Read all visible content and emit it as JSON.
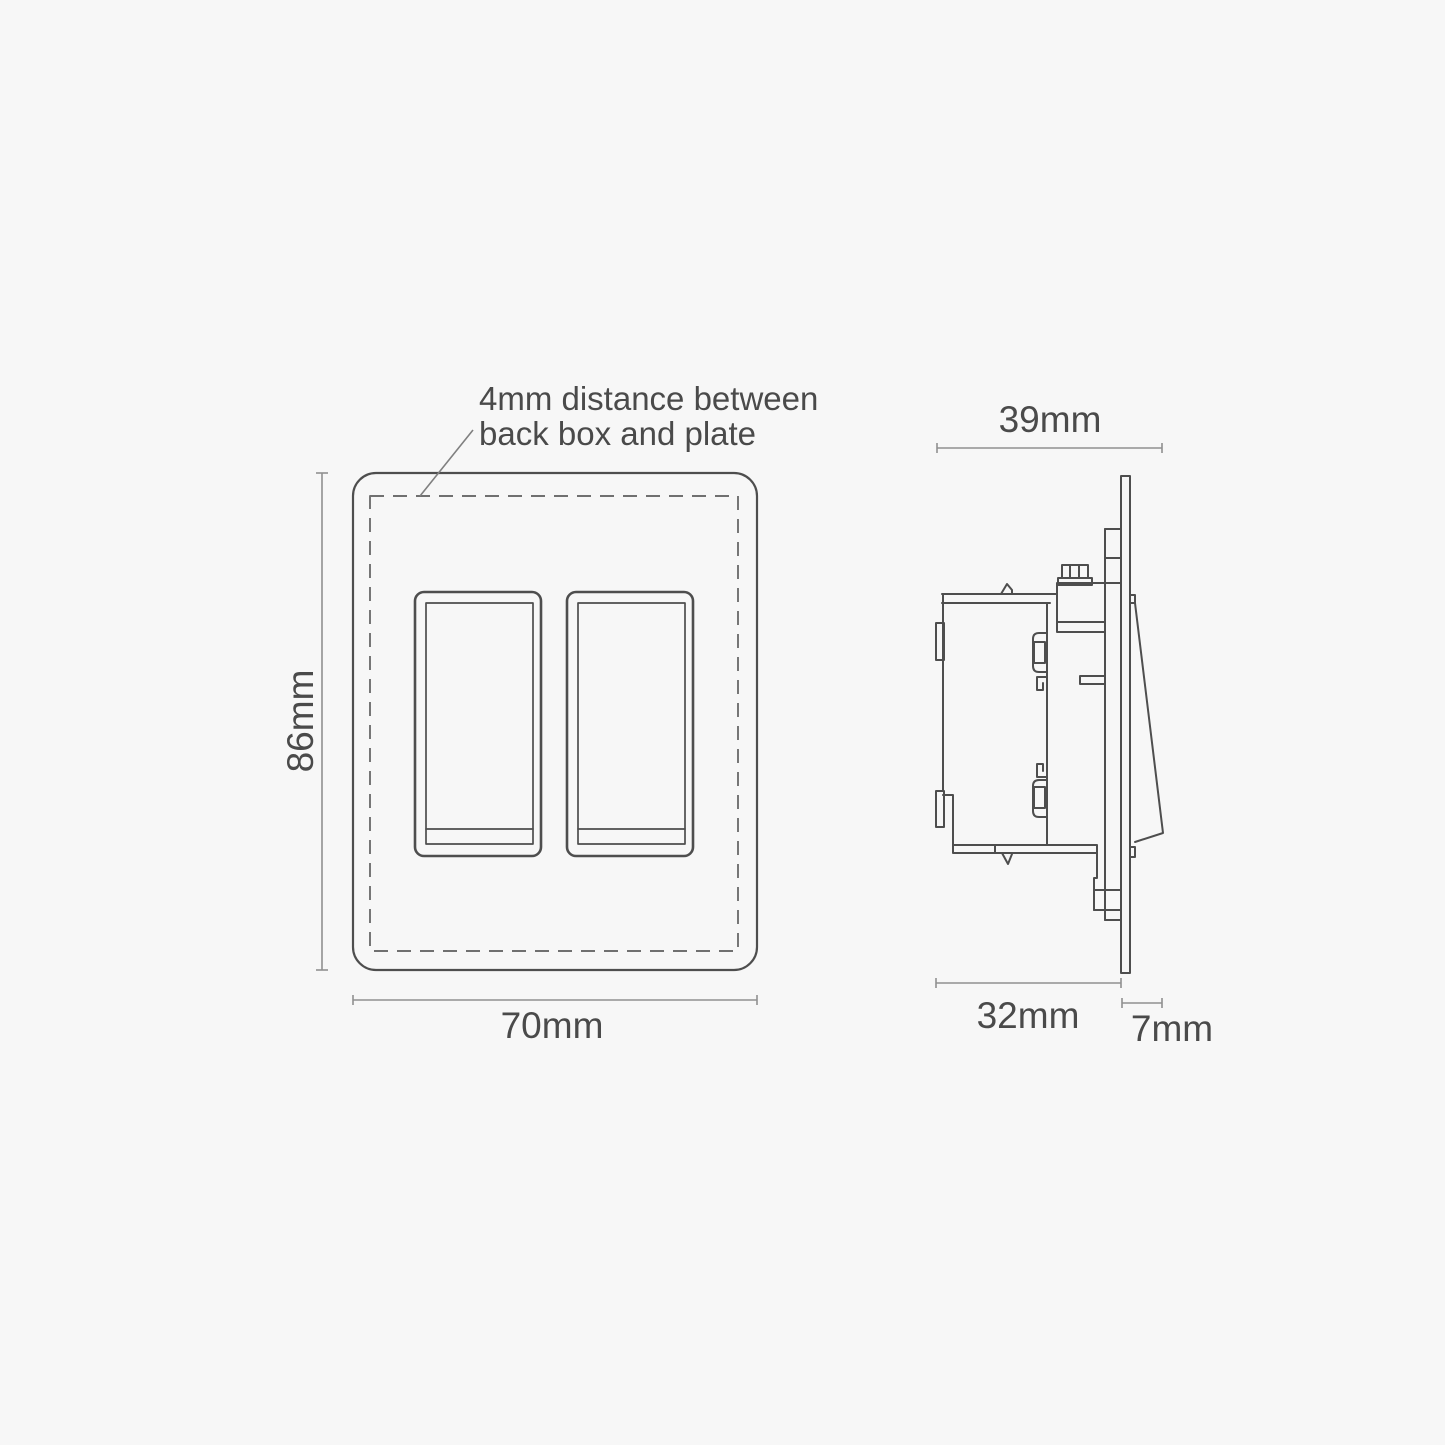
{
  "title": "Double rocker switch installation dimensions diagram",
  "annotation": {
    "line1": "4mm distance between",
    "line2": "back box and plate"
  },
  "front_view": {
    "name": "front view of double rocker switch plate",
    "height_label": "86mm",
    "width_label": "70mm",
    "rocker_count": 2
  },
  "side_view": {
    "name": "side profile of switch, back box and plate",
    "total_depth_label": "39mm",
    "back_box_depth_label": "32mm",
    "plate_depth_label": "7mm"
  },
  "colors": {
    "background": "#f7f7f7",
    "drawing_stroke": "#4e4e4e",
    "dashed_stroke": "#707070",
    "dimension_stroke": "#909090",
    "text": "#4a4a4a"
  }
}
